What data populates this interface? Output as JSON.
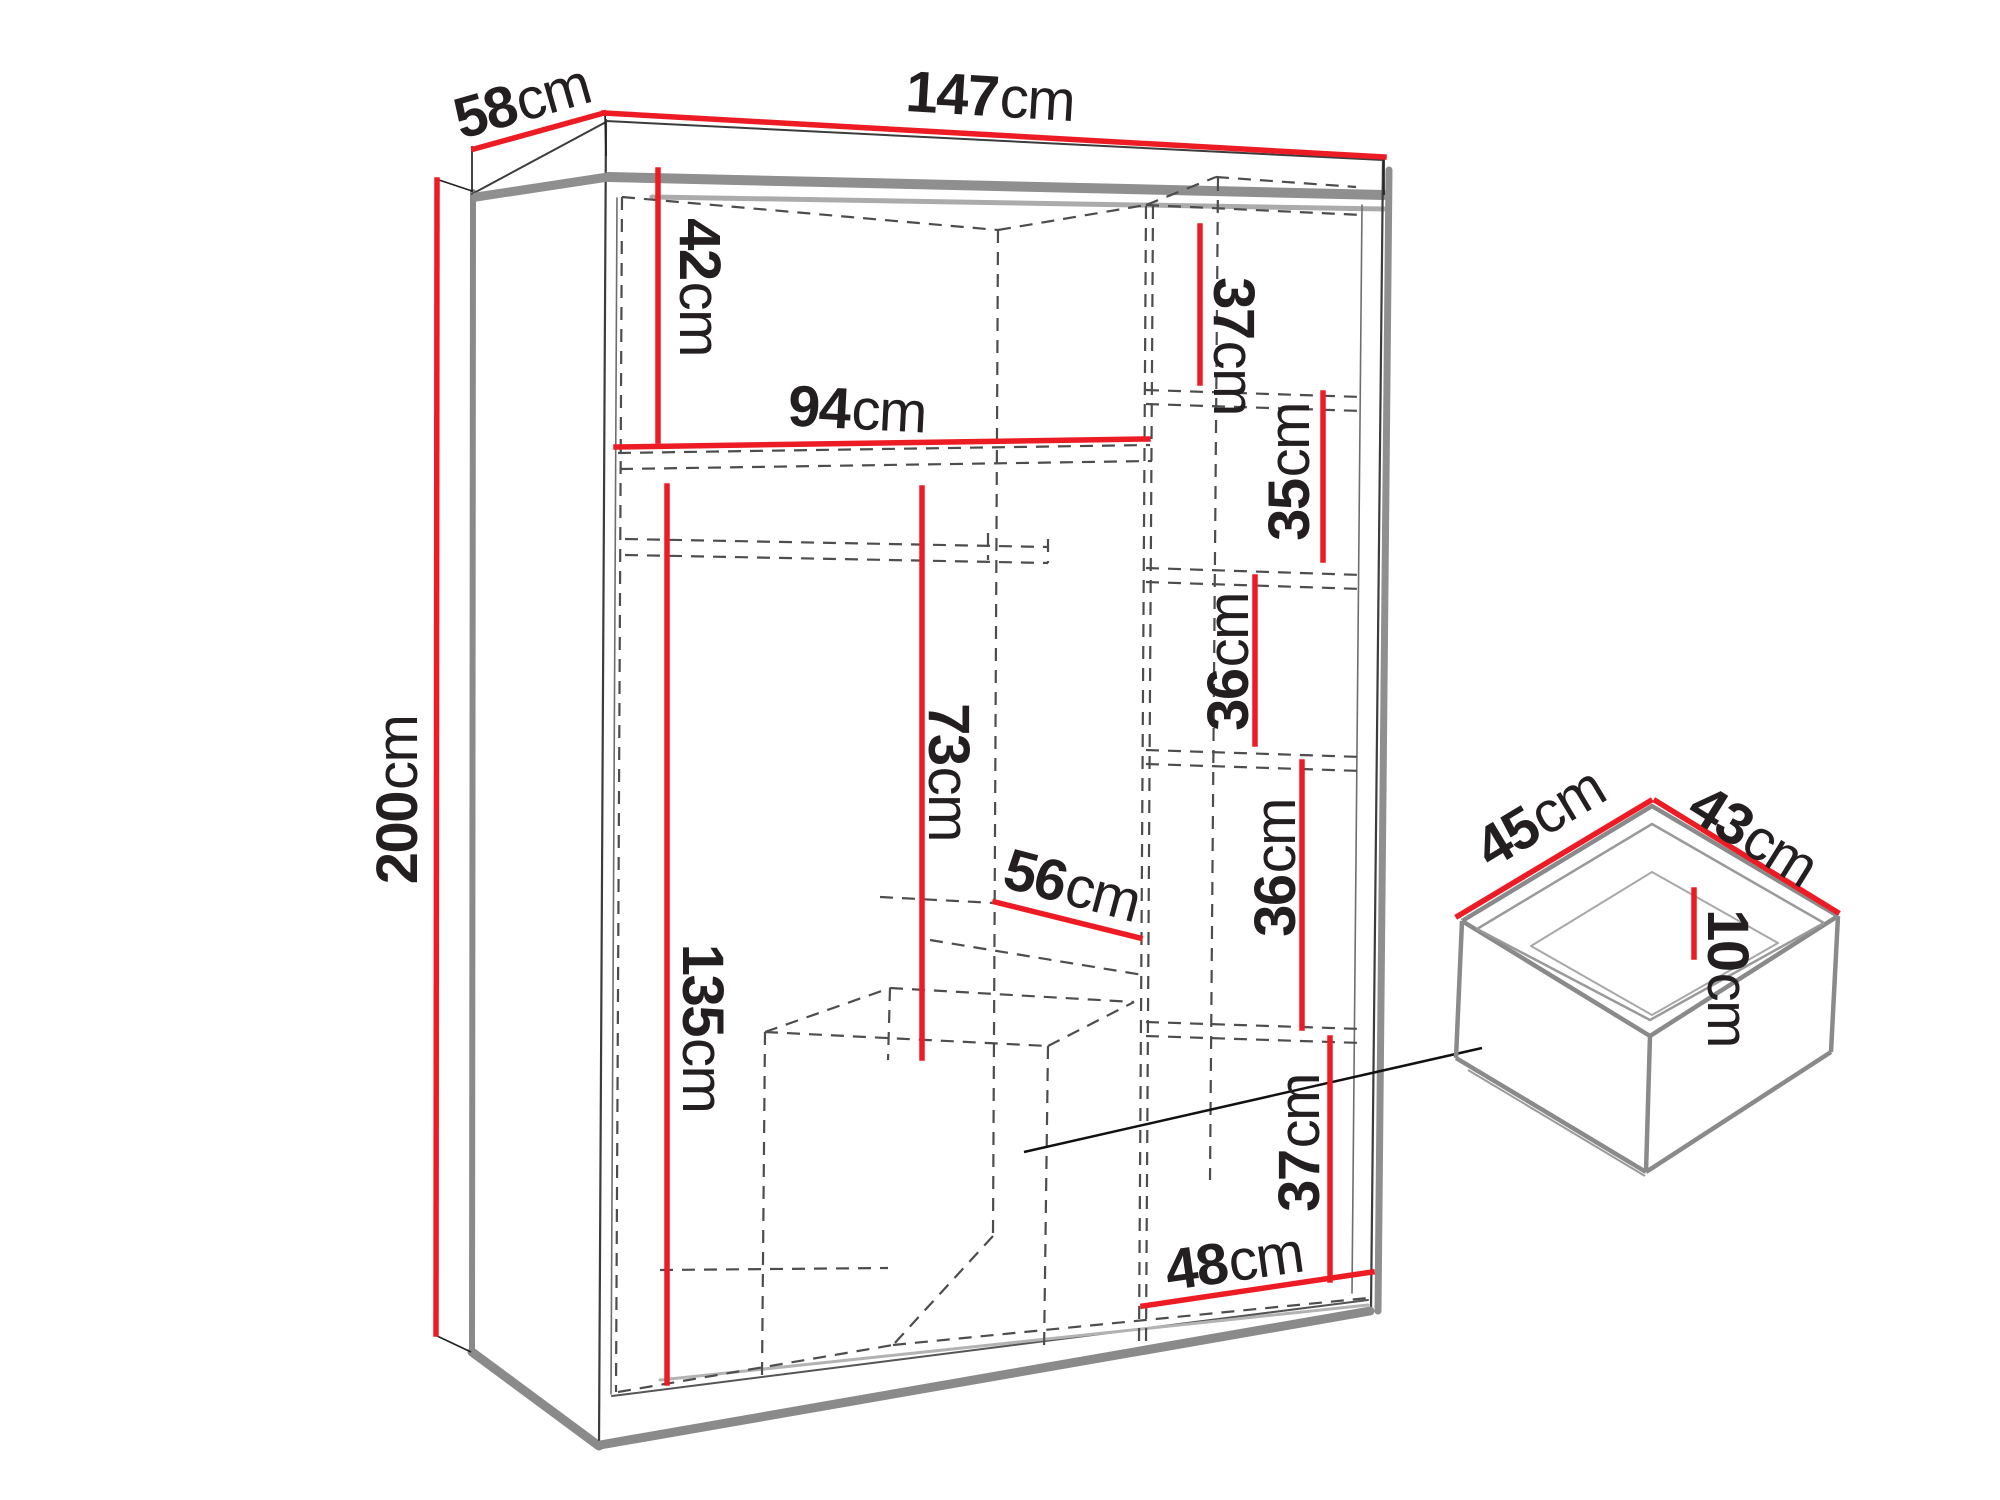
{
  "diagram": {
    "subject": "wardrobe-dimension-diagram",
    "unit": "cm"
  },
  "colors": {
    "red": "#ed1c24",
    "ink": "#231f20",
    "gray": "#8a8a8a",
    "graylight": "#ababab",
    "dash": "#4d4d4d",
    "bg": "#ffffff"
  },
  "dimensions": {
    "width": {
      "value": "147",
      "unit": "cm"
    },
    "depth": {
      "value": "58",
      "unit": "cm"
    },
    "height": {
      "value": "200",
      "unit": "cm"
    },
    "top_left_section_height": {
      "value": "42",
      "unit": "cm"
    },
    "top_shelf_width": {
      "value": "94",
      "unit": "cm"
    },
    "top_right_section_height": {
      "value": "37",
      "unit": "cm"
    },
    "right_shelf_space_1": {
      "value": "35",
      "unit": "cm"
    },
    "right_shelf_space_2": {
      "value": "36",
      "unit": "cm"
    },
    "right_shelf_space_3": {
      "value": "36",
      "unit": "cm"
    },
    "right_bottom_section": {
      "value": "37",
      "unit": "cm"
    },
    "hanging_space_height": {
      "value": "73",
      "unit": "cm"
    },
    "left_section_height": {
      "value": "135",
      "unit": "cm"
    },
    "middle_section_width": {
      "value": "56",
      "unit": "cm"
    },
    "right_section_width": {
      "value": "48",
      "unit": "cm"
    },
    "drawer_depth": {
      "value": "45",
      "unit": "cm"
    },
    "drawer_width": {
      "value": "43",
      "unit": "cm"
    },
    "drawer_inner_height": {
      "value": "10",
      "unit": "cm"
    }
  }
}
